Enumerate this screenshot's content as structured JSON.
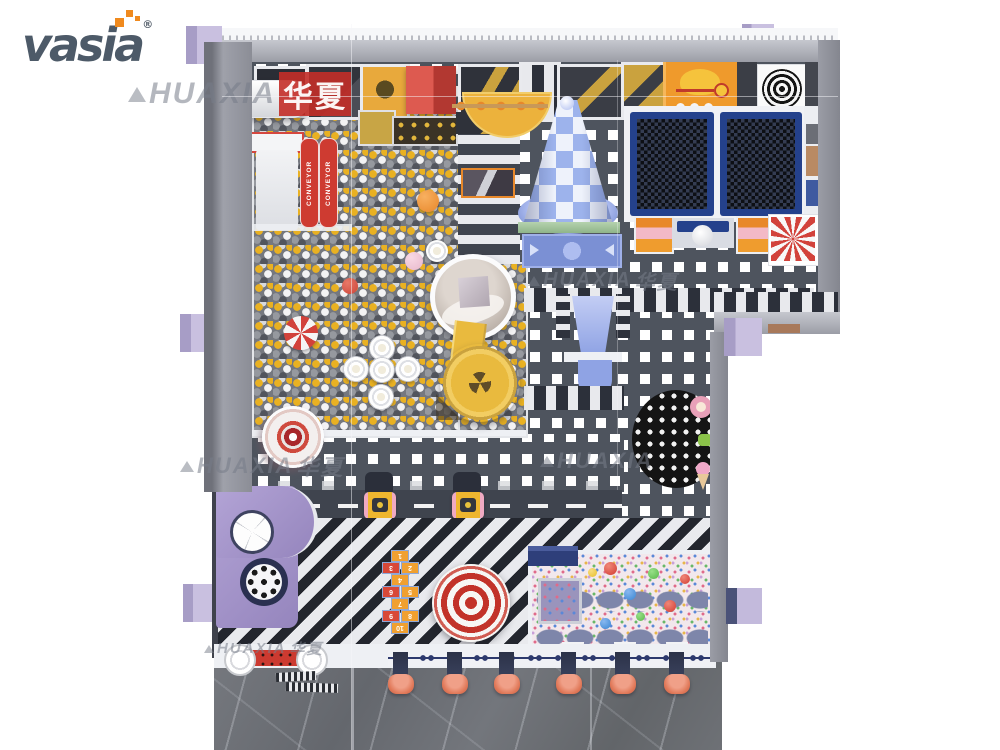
{
  "logo": {
    "text": "vasia",
    "registered_mark": "®",
    "wordmark_color": "#4d5a68",
    "accent_color": "#f08a1e"
  },
  "watermarks": {
    "brand_latin": "HUAXIA",
    "brand_cn": "华夏",
    "rows": [
      {
        "text": "HUAXIA",
        "cn": "华夏"
      },
      {
        "text": "HUAXIA",
        "cn": "华夏"
      },
      {
        "text": "HUAXIA",
        "cn": "华夏"
      },
      {
        "text": "HUAXIA",
        "cn": ""
      },
      {
        "text": "HUAXIA",
        "cn": "华夏"
      }
    ]
  },
  "equipment": {
    "conveyor_label": "CONVEYOR",
    "hopscotch_numbers": [
      "1",
      "2",
      "3",
      "4",
      "5",
      "6",
      "7",
      "8",
      "9",
      "10"
    ]
  },
  "colors": {
    "accent_orange": "#f08a1e",
    "wordmark_gray": "#4d5a68",
    "ball_yellow": "#e9b122",
    "conveyor_red": "#ce3b31",
    "cone_blue": "#9db3ec",
    "trampoline_navy": "#24418c",
    "pinwheel_red": "#d2423b",
    "slide_yellow": "#e9ba3e",
    "structure_purple": "#a292c8",
    "stool_salmon": "#e07858",
    "pillar_lavender": "#c9c0e0",
    "floor_dark": "#4e545e",
    "marble_gray": "#6e7176"
  }
}
